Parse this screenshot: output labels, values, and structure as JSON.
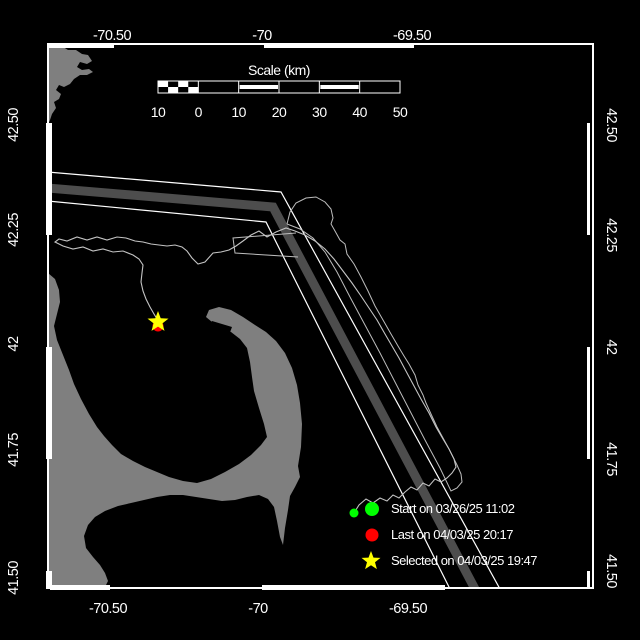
{
  "map": {
    "description": "Drifter track map of Cape Cod Bay / Massachusetts Bay",
    "lon_axis": {
      "top_labels": [
        {
          "text": "-70.50",
          "x": 112
        },
        {
          "text": "-70",
          "x": 262
        },
        {
          "text": "-69.50",
          "x": 412
        }
      ],
      "bottom_labels": [
        {
          "text": "-70.50",
          "x": 108
        },
        {
          "text": "-70",
          "x": 258
        },
        {
          "text": "-69.50",
          "x": 408
        }
      ]
    },
    "lat_axis": {
      "left_labels": [
        {
          "text": "42.50",
          "y": 125
        },
        {
          "text": "42.25",
          "y": 230
        },
        {
          "text": "42",
          "y": 344
        },
        {
          "text": "41.75",
          "y": 450
        },
        {
          "text": "41.50",
          "y": 578
        }
      ],
      "right_labels": [
        {
          "text": "42.50",
          "y": 125
        },
        {
          "text": "42.25",
          "y": 235
        },
        {
          "text": "42",
          "y": 347
        },
        {
          "text": "41.75",
          "y": 459
        },
        {
          "text": "41.50",
          "y": 571
        }
      ]
    },
    "frame": {
      "left": 48,
      "top": 44,
      "right": 593,
      "bottom": 588,
      "thick_top": [
        [
          48,
          114
        ],
        [
          264,
          414
        ]
      ],
      "thick_bottom": [
        [
          50,
          110
        ],
        [
          262,
          445
        ]
      ],
      "thick_left": [
        [
          123,
          235
        ],
        [
          347,
          459
        ],
        [
          571,
          589
        ]
      ],
      "thick_right": [
        [
          123,
          235
        ],
        [
          347,
          459
        ],
        [
          571,
          589
        ]
      ]
    }
  },
  "scale_bar": {
    "title": "Scale (km)",
    "x0": 158,
    "x1": 400,
    "y0": 81,
    "y1": 93,
    "tick_labels": [
      "10",
      "0",
      "10",
      "20",
      "30",
      "40",
      "50"
    ],
    "striped_sections": [
      2,
      4
    ],
    "checker_section": 0
  },
  "legend": {
    "x_marker": 372,
    "x_text": 391,
    "items": [
      {
        "marker": "dot",
        "color": "#00ff00",
        "label": "Start on 03/26/25 11:02",
        "y": 509
      },
      {
        "marker": "dot",
        "color": "#ff0000",
        "label": "Last on 04/03/25 20:17",
        "y": 535
      },
      {
        "marker": "star",
        "color": "#ffff00",
        "label": "Selected on 04/03/25 19:47",
        "y": 561
      }
    ]
  },
  "markers": {
    "start": {
      "x": 354,
      "y": 513,
      "r": 4.5,
      "color": "#00ff00"
    },
    "last": {
      "x": 158,
      "y": 326,
      "r": 5.5,
      "color": "#ff0000"
    },
    "selected": {
      "x": 158,
      "y": 322,
      "r": 11,
      "color": "#ffff00"
    }
  },
  "colors": {
    "background": "#000000",
    "frame": "#ffffff",
    "land": "#7f7f7f",
    "lane_line": "#ffffff",
    "lane_band": "#4d4d4d",
    "track": "#c4c4c4",
    "sanctuary": "#bdbdbd",
    "text": "#ffffff"
  },
  "map_features": {
    "land_cape_ann": [
      [
        48,
        46
      ],
      [
        60,
        45
      ],
      [
        68,
        50
      ],
      [
        76,
        50
      ],
      [
        82,
        54
      ],
      [
        88,
        55
      ],
      [
        92,
        61
      ],
      [
        87,
        64
      ],
      [
        80,
        62
      ],
      [
        77,
        67
      ],
      [
        82,
        70
      ],
      [
        89,
        69
      ],
      [
        93,
        72
      ],
      [
        87,
        75
      ],
      [
        80,
        75
      ],
      [
        74,
        79
      ],
      [
        70,
        84
      ],
      [
        64,
        87
      ],
      [
        59,
        85
      ],
      [
        56,
        90
      ],
      [
        61,
        94
      ],
      [
        59,
        99
      ],
      [
        54,
        102
      ],
      [
        56,
        108
      ],
      [
        52,
        114
      ],
      [
        50,
        120
      ],
      [
        48,
        125
      ]
    ],
    "land_main": [
      [
        48,
        273
      ],
      [
        55,
        279
      ],
      [
        59,
        290
      ],
      [
        60,
        302
      ],
      [
        57,
        314
      ],
      [
        54,
        326
      ],
      [
        57,
        340
      ],
      [
        63,
        355
      ],
      [
        69,
        370
      ],
      [
        74,
        384
      ],
      [
        81,
        399
      ],
      [
        89,
        414
      ],
      [
        97,
        427
      ],
      [
        104,
        436
      ],
      [
        112,
        445
      ],
      [
        121,
        454
      ],
      [
        133,
        461
      ],
      [
        145,
        467
      ],
      [
        157,
        472
      ],
      [
        169,
        477
      ],
      [
        183,
        481
      ],
      [
        197,
        483
      ],
      [
        211,
        479
      ],
      [
        225,
        472
      ],
      [
        239,
        464
      ],
      [
        251,
        455
      ],
      [
        261,
        445
      ],
      [
        267,
        437
      ],
      [
        264,
        424
      ],
      [
        259,
        408
      ],
      [
        254,
        391
      ],
      [
        252,
        377
      ],
      [
        250,
        362
      ],
      [
        247,
        348
      ],
      [
        240,
        339
      ],
      [
        231,
        332
      ],
      [
        221,
        327
      ],
      [
        212,
        322
      ],
      [
        206,
        317
      ],
      [
        209,
        310
      ],
      [
        219,
        307
      ],
      [
        231,
        310
      ],
      [
        243,
        317
      ],
      [
        255,
        325
      ],
      [
        266,
        332
      ],
      [
        276,
        341
      ],
      [
        285,
        353
      ],
      [
        292,
        368
      ],
      [
        297,
        385
      ],
      [
        300,
        403
      ],
      [
        302,
        424
      ],
      [
        301,
        447
      ],
      [
        298,
        466
      ],
      [
        300,
        477
      ],
      [
        295,
        487
      ],
      [
        290,
        496
      ],
      [
        288,
        510
      ],
      [
        285,
        528
      ],
      [
        283,
        545
      ],
      [
        280,
        537
      ],
      [
        277,
        521
      ],
      [
        274,
        507
      ],
      [
        268,
        499
      ],
      [
        259,
        495
      ],
      [
        247,
        497
      ],
      [
        235,
        500
      ],
      [
        222,
        501
      ],
      [
        209,
        499
      ],
      [
        196,
        497
      ],
      [
        183,
        495
      ],
      [
        170,
        495
      ],
      [
        157,
        497
      ],
      [
        144,
        500
      ],
      [
        131,
        503
      ],
      [
        118,
        506
      ],
      [
        105,
        511
      ],
      [
        95,
        517
      ],
      [
        88,
        525
      ],
      [
        84,
        536
      ],
      [
        86,
        548
      ],
      [
        93,
        557
      ],
      [
        100,
        565
      ],
      [
        105,
        573
      ],
      [
        108,
        581
      ],
      [
        104,
        589
      ],
      [
        48,
        589
      ]
    ],
    "harbor_notch": [
      [
        212,
        321
      ],
      [
        232,
        327
      ],
      [
        229,
        335
      ],
      [
        208,
        328
      ]
    ],
    "lane_line_a": [
      [
        48,
        172
      ],
      [
        281,
        192
      ],
      [
        500,
        589
      ]
    ],
    "lane_line_b": [
      [
        48,
        201
      ],
      [
        266,
        222
      ],
      [
        450,
        589
      ]
    ],
    "lane_band": [
      [
        48,
        188
      ],
      [
        273,
        207
      ],
      [
        475,
        589
      ]
    ],
    "sanctuary": [
      [
        287,
        224
      ],
      [
        290,
        212
      ],
      [
        296,
        203
      ],
      [
        306,
        198
      ],
      [
        316,
        197
      ],
      [
        325,
        202
      ],
      [
        331,
        209
      ],
      [
        333,
        218
      ],
      [
        331,
        224
      ],
      [
        335,
        231
      ],
      [
        340,
        240
      ],
      [
        345,
        244
      ],
      [
        347,
        254
      ],
      [
        354,
        264
      ],
      [
        361,
        277
      ],
      [
        368,
        291
      ],
      [
        375,
        306
      ],
      [
        383,
        320
      ],
      [
        391,
        334
      ],
      [
        398,
        346
      ],
      [
        404,
        356
      ],
      [
        409,
        364
      ],
      [
        415,
        375
      ],
      [
        418,
        385
      ],
      [
        423,
        395
      ],
      [
        426,
        403
      ],
      [
        431,
        414
      ],
      [
        437,
        427
      ],
      [
        443,
        438
      ],
      [
        449,
        449
      ],
      [
        453,
        457
      ],
      [
        457,
        465
      ],
      [
        461,
        474
      ],
      [
        462,
        482
      ],
      [
        457,
        488
      ],
      [
        451,
        491
      ],
      [
        440,
        468
      ],
      [
        425,
        440
      ],
      [
        410,
        411
      ],
      [
        395,
        382
      ],
      [
        380,
        353
      ],
      [
        365,
        325
      ],
      [
        350,
        297
      ],
      [
        337,
        272
      ],
      [
        325,
        252
      ],
      [
        313,
        238
      ],
      [
        300,
        229
      ],
      [
        287,
        224
      ]
    ],
    "sanctuary_nw_notch": [
      [
        296,
        233
      ],
      [
        233,
        238
      ],
      [
        235,
        253
      ],
      [
        298,
        257
      ]
    ],
    "track": [
      [
        354,
        513
      ],
      [
        359,
        505
      ],
      [
        366,
        499
      ],
      [
        373,
        503
      ],
      [
        380,
        498
      ],
      [
        387,
        501
      ],
      [
        393,
        495
      ],
      [
        399,
        498
      ],
      [
        405,
        492
      ],
      [
        411,
        487
      ],
      [
        417,
        490
      ],
      [
        423,
        483
      ],
      [
        429,
        486
      ],
      [
        435,
        479
      ],
      [
        441,
        482
      ],
      [
        447,
        478
      ],
      [
        452,
        473
      ],
      [
        456,
        467
      ],
      [
        454,
        459
      ],
      [
        449,
        449
      ],
      [
        443,
        439
      ],
      [
        436,
        427
      ],
      [
        429,
        413
      ],
      [
        421,
        399
      ],
      [
        414,
        386
      ],
      [
        407,
        373
      ],
      [
        399,
        358
      ],
      [
        392,
        346
      ],
      [
        385,
        334
      ],
      [
        377,
        320
      ],
      [
        369,
        308
      ],
      [
        361,
        296
      ],
      [
        352,
        283
      ],
      [
        343,
        271
      ],
      [
        334,
        259
      ],
      [
        325,
        249
      ],
      [
        315,
        241
      ],
      [
        305,
        235
      ],
      [
        295,
        231
      ],
      [
        286,
        228
      ],
      [
        276,
        232
      ],
      [
        267,
        237
      ],
      [
        259,
        231
      ],
      [
        251,
        235
      ],
      [
        243,
        241
      ],
      [
        236,
        246
      ],
      [
        229,
        250
      ],
      [
        221,
        252
      ],
      [
        213,
        253
      ],
      [
        205,
        262
      ],
      [
        198,
        264
      ],
      [
        192,
        258
      ],
      [
        187,
        251
      ],
      [
        182,
        247
      ],
      [
        175,
        245
      ],
      [
        167,
        246
      ],
      [
        159,
        245
      ],
      [
        151,
        244
      ],
      [
        143,
        242
      ],
      [
        135,
        241
      ],
      [
        126,
        238
      ],
      [
        117,
        237
      ],
      [
        107,
        240
      ],
      [
        97,
        237
      ],
      [
        87,
        240
      ],
      [
        77,
        237
      ],
      [
        67,
        241
      ],
      [
        59,
        239
      ],
      [
        55,
        242
      ],
      [
        63,
        246
      ],
      [
        73,
        249
      ],
      [
        83,
        247
      ],
      [
        93,
        251
      ],
      [
        103,
        249
      ],
      [
        113,
        252
      ],
      [
        123,
        251
      ],
      [
        133,
        255
      ],
      [
        139,
        259
      ],
      [
        143,
        265
      ],
      [
        142,
        273
      ],
      [
        141,
        282
      ],
      [
        143,
        291
      ],
      [
        146,
        299
      ],
      [
        150,
        307
      ],
      [
        154,
        314
      ],
      [
        157,
        319
      ],
      [
        158,
        322
      ]
    ]
  }
}
